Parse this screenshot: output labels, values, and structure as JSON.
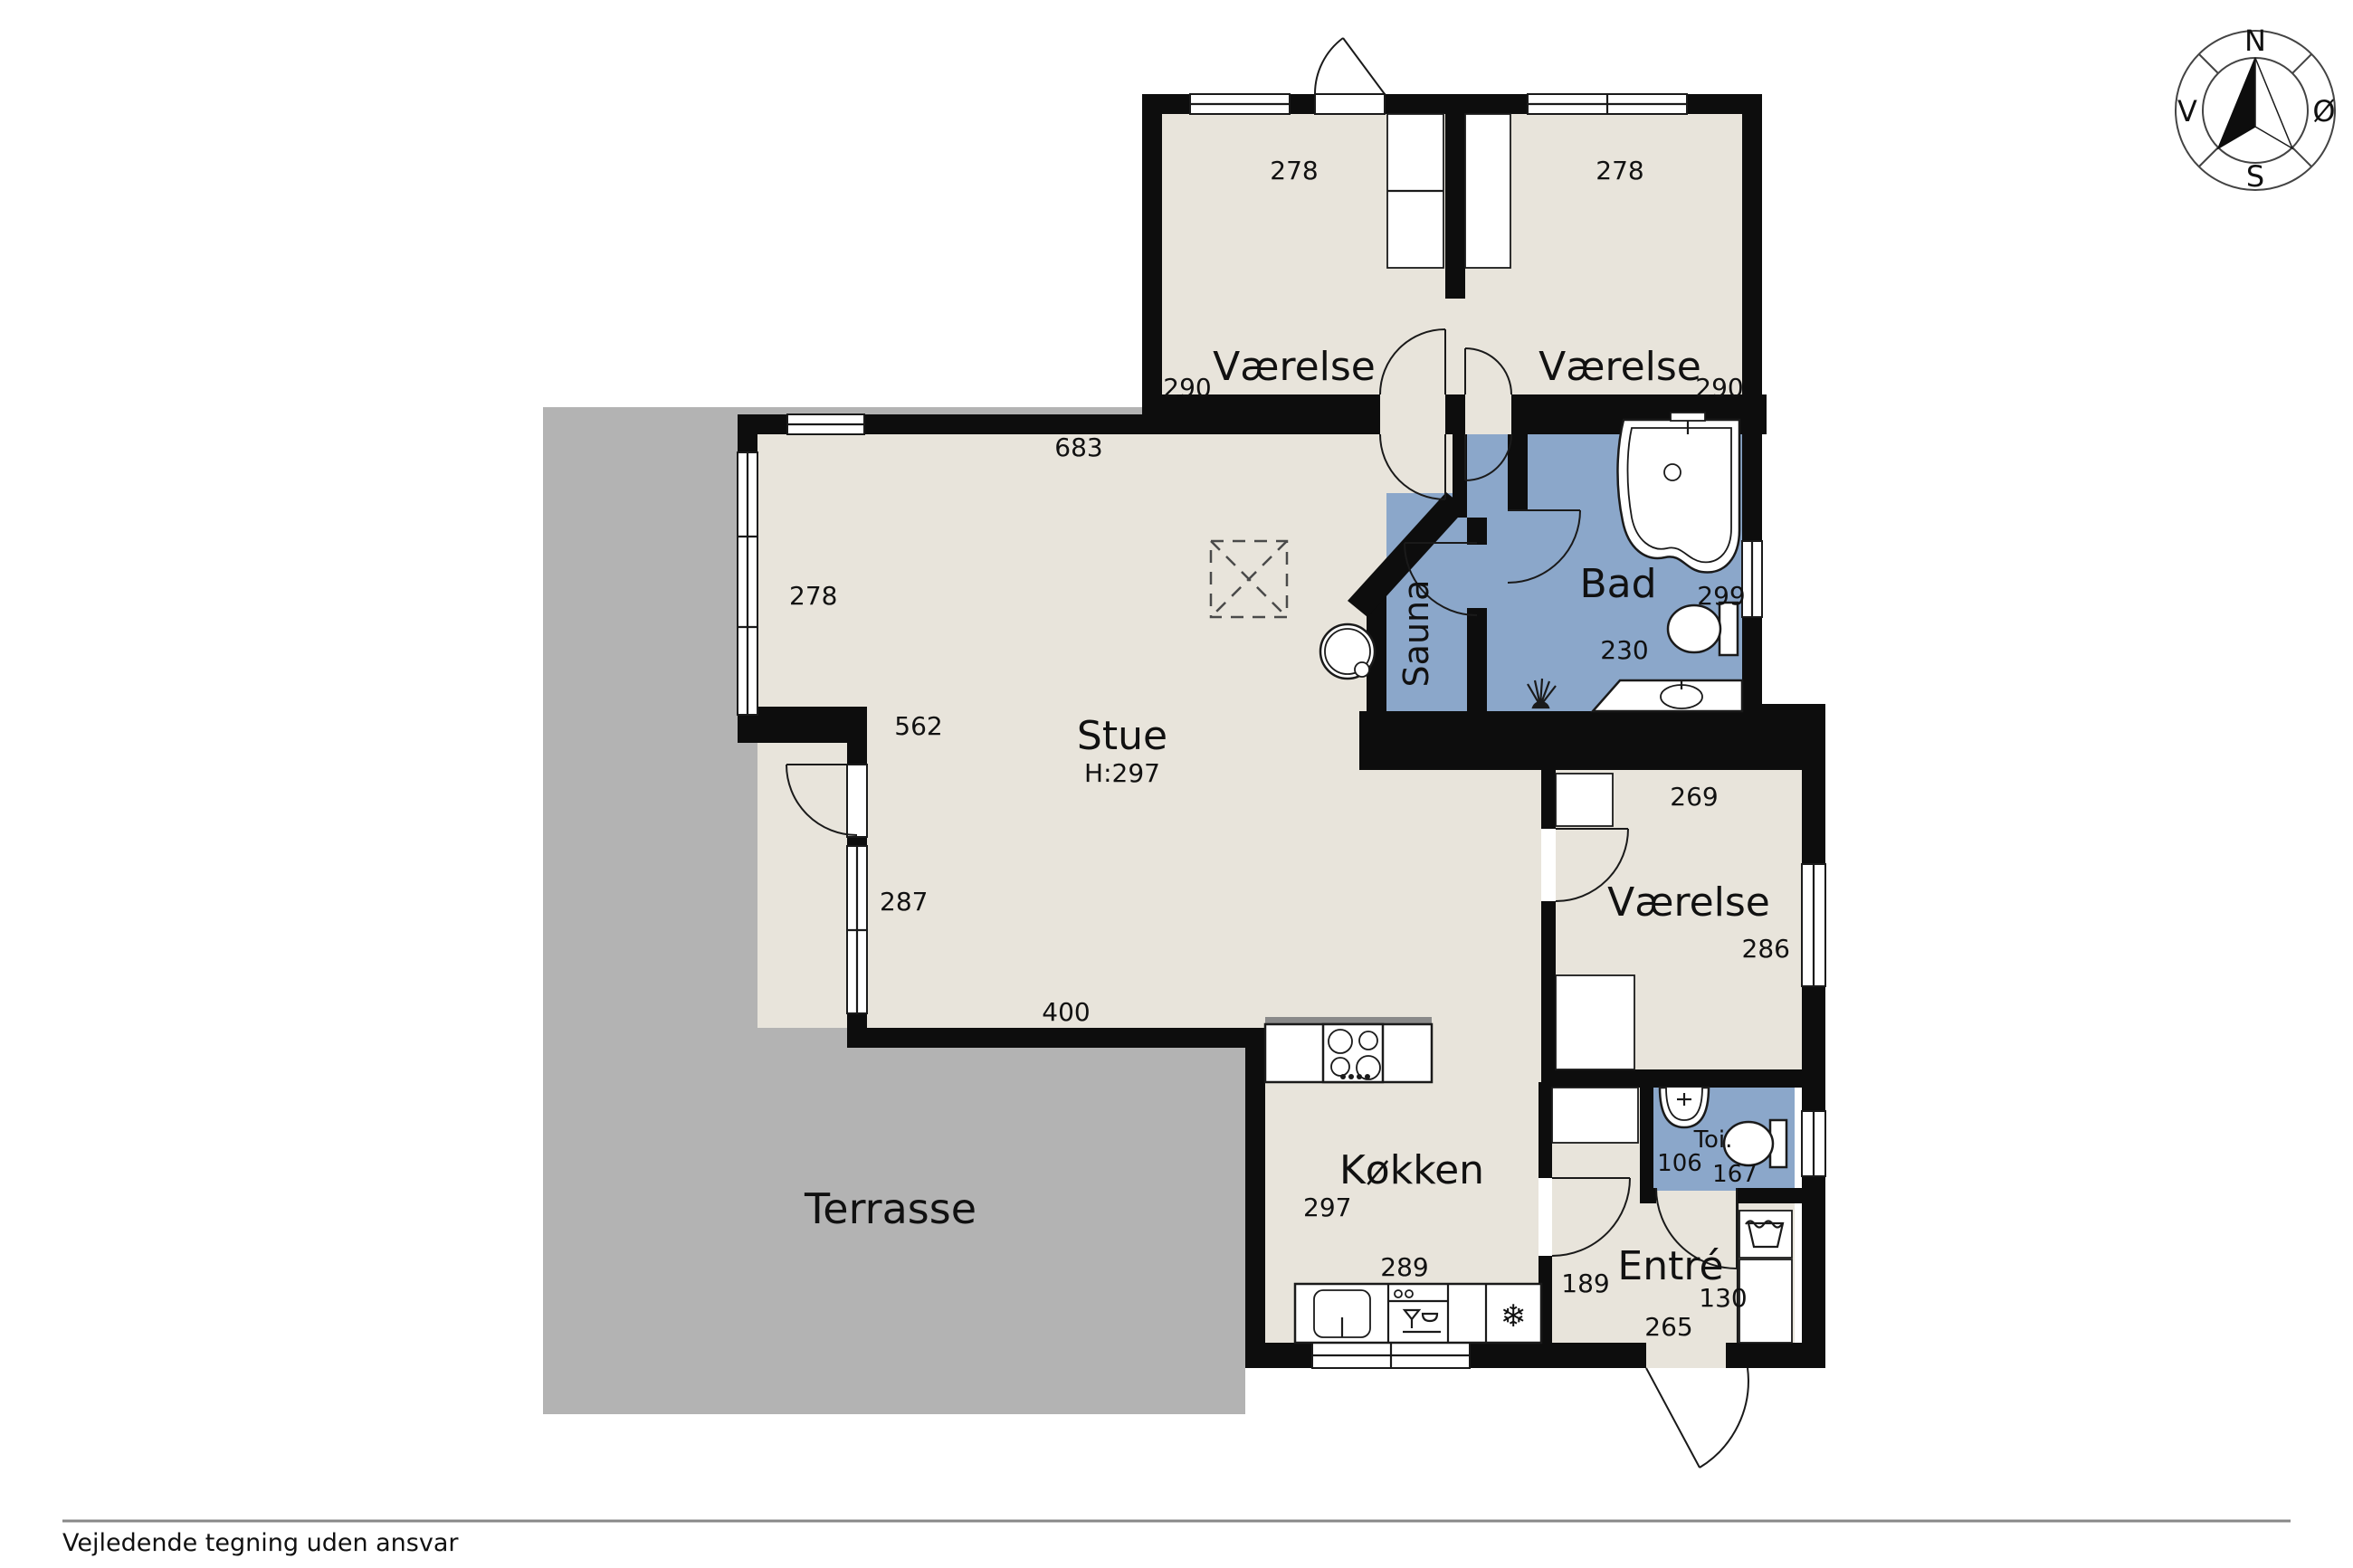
{
  "palette": {
    "floor": "#e8e4db",
    "wet_room": "#8ba7ca",
    "terrace": "#b3b3b3",
    "wall": "#0d0d0d",
    "footer_line": "#888888"
  },
  "rooms": {
    "bedroom_tl": {
      "label": "Værelse",
      "width": "278",
      "depth": "290"
    },
    "bedroom_tr": {
      "label": "Værelse",
      "width": "278",
      "depth": "290"
    },
    "living": {
      "label": "Stue",
      "height": "H:297",
      "d_top": "683",
      "d_win_upper": "278",
      "d_mid": "562",
      "d_win_lower": "287",
      "d_bottom": "400"
    },
    "sauna": {
      "label": "Sauna"
    },
    "bath": {
      "label": "Bad",
      "d_height": "299",
      "d_width": "230"
    },
    "bedroom_r": {
      "label": "Værelse",
      "d_top": "269",
      "d_right": "286"
    },
    "kitchen": {
      "label": "Køkken",
      "d_left": "297",
      "d_bottom": "289"
    },
    "toilet": {
      "label": "Toi.",
      "d_left": "106",
      "d_bottom": "167"
    },
    "entry": {
      "label": "Entré",
      "d_left": "189",
      "d_right": "130",
      "d_bottom": "265"
    },
    "terrace": {
      "label": "Terrasse"
    }
  },
  "icons": {
    "fridge": "❄"
  },
  "compass": {
    "n": "N",
    "e": "Ø",
    "s": "S",
    "w": "V"
  },
  "footer": {
    "disclaimer": "Vejledende tegning uden ansvar"
  }
}
